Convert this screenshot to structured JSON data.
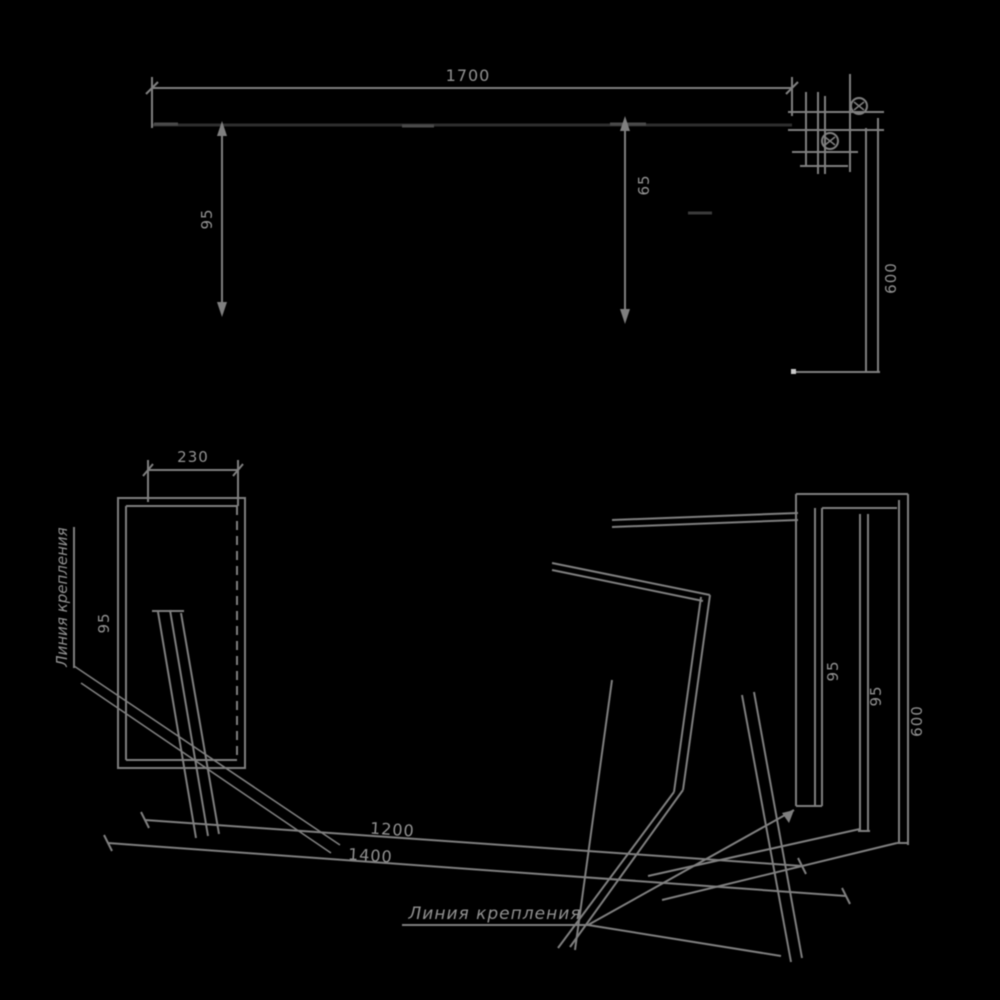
{
  "drawing": {
    "title": "wall-mounted console assembly drawing",
    "background_color": "#000000",
    "line_color": "#7f7f7f",
    "faint_edge_color": "#2e2e2e",
    "text_color": "#919191"
  },
  "front_view": {
    "width": "1700",
    "left_height": "95",
    "mid_height": "65",
    "right_height": "600"
  },
  "side_view": {
    "depth": "230",
    "offset": "95",
    "note": "Линия крепления"
  },
  "perspective_view": {
    "length": "1200",
    "overall_length": "1400",
    "rail_depth": "95",
    "rail_width": "95",
    "rail_height": "600",
    "note": "Линия крепления"
  }
}
